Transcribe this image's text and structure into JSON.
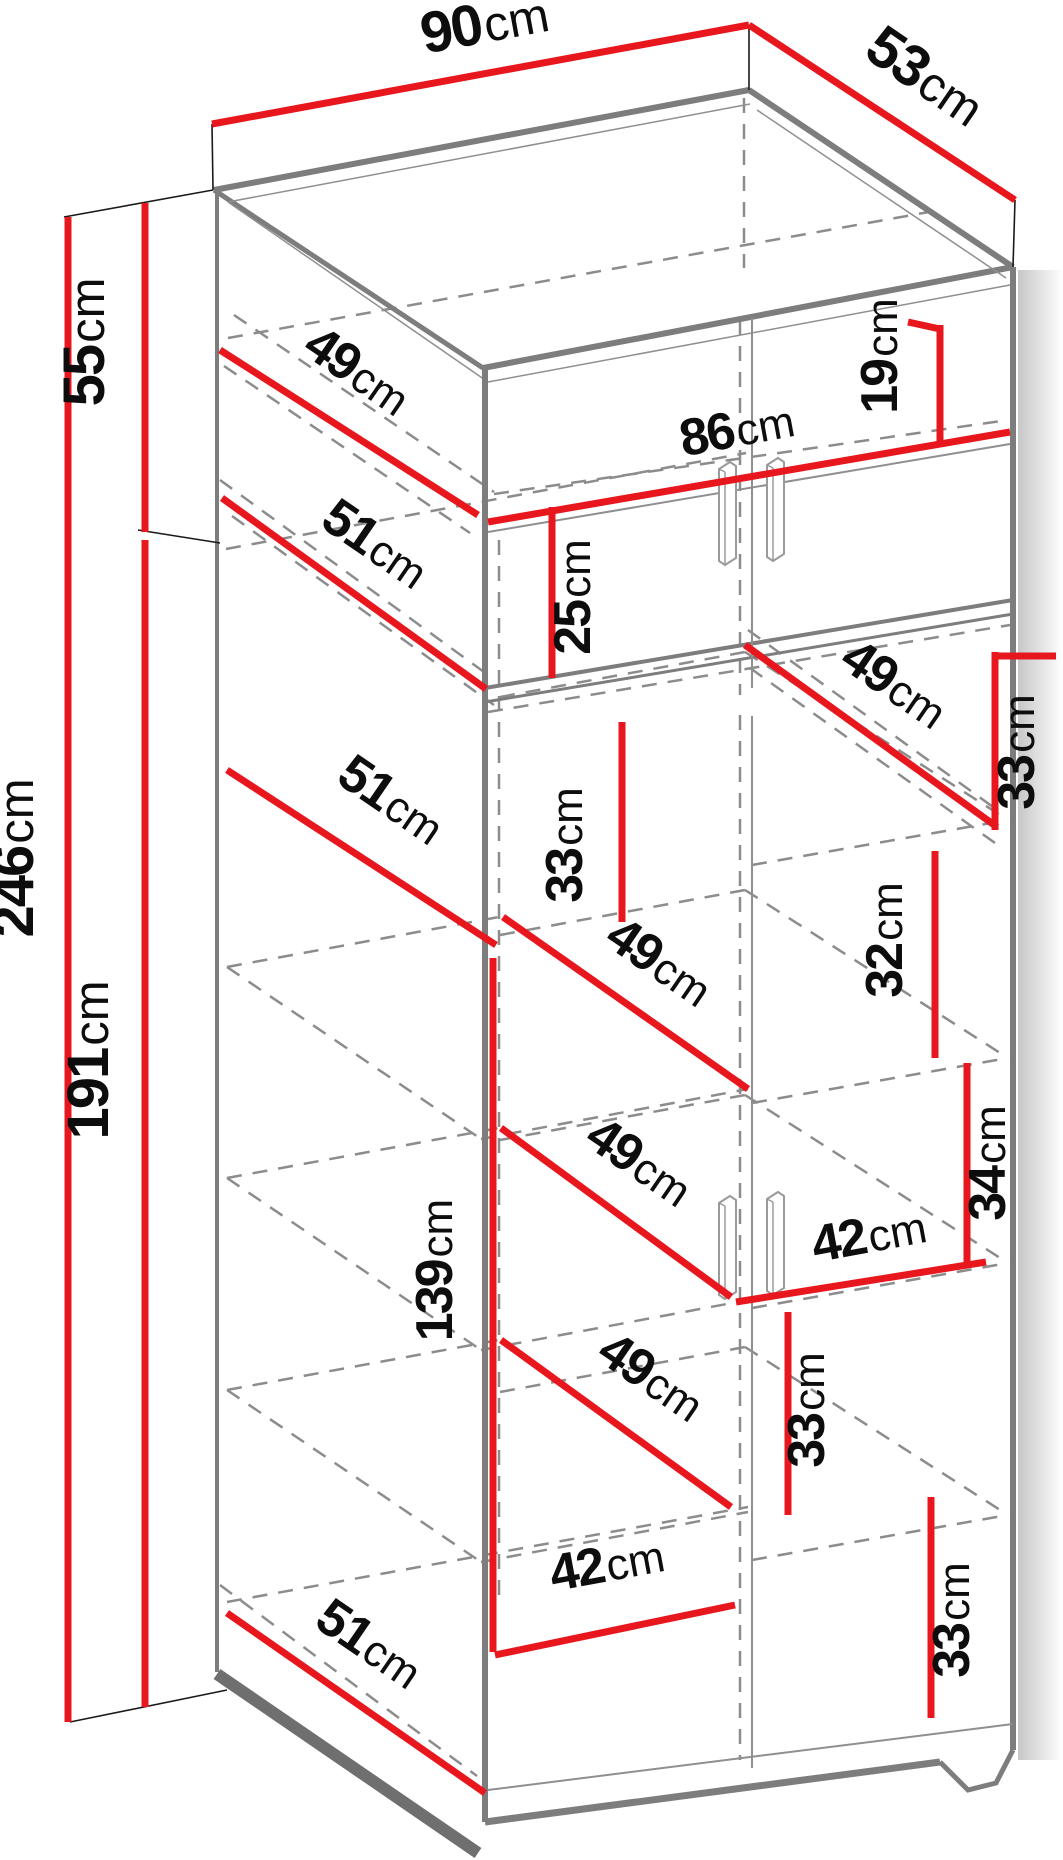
{
  "diagram": {
    "subject": "Tall two-door wardrobe cabinet dimension drawing",
    "view": "oblique projection with hidden shelf edges dashed"
  },
  "colors": {
    "dimension_line": "#e8171d",
    "visible_edge": "#7d7d7d",
    "hidden_edge": "#8c8c8c",
    "extension_line": "#1a1a1a",
    "label_text": "#0d0d0d",
    "background": "#ffffff"
  },
  "dims": {
    "overall_width": {
      "value": "90",
      "unit": "cm"
    },
    "overall_depth": {
      "value": "53",
      "unit": "cm"
    },
    "upper_section_height": {
      "value": "55",
      "unit": "cm"
    },
    "overall_height": {
      "value": "246",
      "unit": "cm"
    },
    "lower_section_height": {
      "value": "191",
      "unit": "cm"
    },
    "upper_interior_depth": {
      "value": "49",
      "unit": "cm"
    },
    "upper_shelf_depth": {
      "value": "51",
      "unit": "cm"
    },
    "interior_width": {
      "value": "86",
      "unit": "cm"
    },
    "upper_right_opening_height": {
      "value": "19",
      "unit": "cm"
    },
    "upper_left_opening_height": {
      "value": "25",
      "unit": "cm"
    },
    "right_top_shelf_depth": {
      "value": "49",
      "unit": "cm"
    },
    "right_opening_height_1": {
      "value": "33",
      "unit": "cm"
    },
    "left_opening_height_1": {
      "value": "33",
      "unit": "cm"
    },
    "middle_shelf_depth": {
      "value": "51",
      "unit": "cm"
    },
    "left_shelf_depth_1": {
      "value": "49",
      "unit": "cm"
    },
    "right_opening_height_2": {
      "value": "32",
      "unit": "cm"
    },
    "right_opening_height_3": {
      "value": "34",
      "unit": "cm"
    },
    "left_interior_height": {
      "value": "139",
      "unit": "cm"
    },
    "left_shelf_depth_2": {
      "value": "49",
      "unit": "cm"
    },
    "right_shelf_width": {
      "value": "42",
      "unit": "cm"
    },
    "center_opening_height": {
      "value": "33",
      "unit": "cm"
    },
    "left_shelf_depth_3": {
      "value": "49",
      "unit": "cm"
    },
    "right_opening_height_4": {
      "value": "33",
      "unit": "cm"
    },
    "left_shelf_width": {
      "value": "42",
      "unit": "cm"
    },
    "bottom_shelf_depth": {
      "value": "51",
      "unit": "cm"
    }
  }
}
